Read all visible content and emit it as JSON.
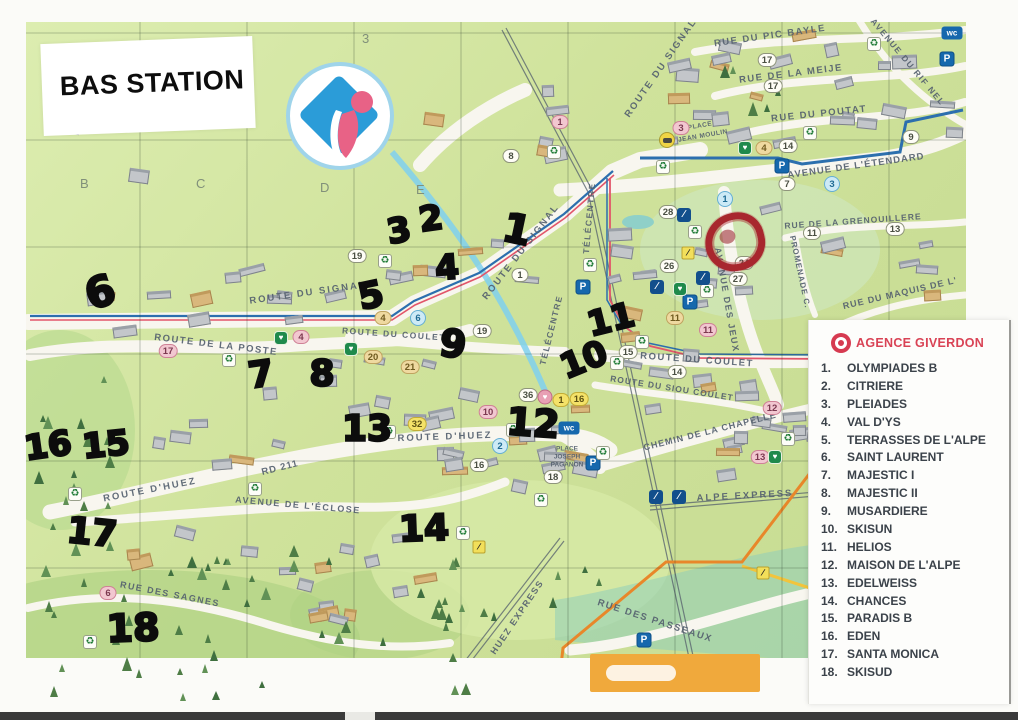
{
  "page": {
    "title": "BAS STATION"
  },
  "legend": {
    "agency": "AGENCE GIVERDON",
    "items": [
      {
        "num": "1.",
        "label": "OLYMPIADES B"
      },
      {
        "num": "2.",
        "label": "CITRIERE"
      },
      {
        "num": "3.",
        "label": "PLEIADES"
      },
      {
        "num": "4.",
        "label": "VAL D'YS"
      },
      {
        "num": "5.",
        "label": "TERRASSES DE L'ALPE"
      },
      {
        "num": "6.",
        "label": "SAINT LAURENT"
      },
      {
        "num": "7.",
        "label": "MAJESTIC I"
      },
      {
        "num": "8.",
        "label": "MAJESTIC II"
      },
      {
        "num": "9.",
        "label": "MUSARDIERE"
      },
      {
        "num": "10.",
        "label": "SKISUN"
      },
      {
        "num": "11.",
        "label": "HELIOS"
      },
      {
        "num": "12.",
        "label": "MAISON DE L'ALPE"
      },
      {
        "num": "13.",
        "label": "EDELWEISS"
      },
      {
        "num": "14.",
        "label": "CHANCES"
      },
      {
        "num": "15.",
        "label": "PARADIS B"
      },
      {
        "num": "16.",
        "label": "EDEN"
      },
      {
        "num": "17.",
        "label": "SANTA MONICA"
      },
      {
        "num": "18.",
        "label": "SKISUD"
      }
    ]
  },
  "map": {
    "grid_labels": [
      {
        "text": "3",
        "x": 362,
        "y": 31
      },
      {
        "text": "B",
        "x": 80,
        "y": 176
      },
      {
        "text": "C",
        "x": 196,
        "y": 176
      },
      {
        "text": "D",
        "x": 320,
        "y": 180
      },
      {
        "text": "E",
        "x": 416,
        "y": 182
      }
    ],
    "streets": [
      {
        "label": "ROUTE DU SIGNAL",
        "x": 308,
        "y": 293,
        "rot": -8,
        "size": 9.5,
        "ls": 2
      },
      {
        "label": "ROUTE DU SIGNAL",
        "x": 521,
        "y": 252,
        "rot": -52,
        "size": 9.5,
        "ls": 2
      },
      {
        "label": "ROUTE DU SIGNAL",
        "x": 661,
        "y": 68,
        "rot": -55,
        "size": 9.5,
        "ls": 2
      },
      {
        "label": "RUE DU PIC BAYLE",
        "x": 770,
        "y": 36,
        "rot": -8,
        "size": 9.5,
        "ls": 1.5
      },
      {
        "label": "RUE DE LA MEIJE",
        "x": 791,
        "y": 74,
        "rot": -7,
        "size": 9.5,
        "ls": 1.5
      },
      {
        "label": "RUE DU POUTAT",
        "x": 819,
        "y": 114,
        "rot": -6,
        "size": 9.5,
        "ls": 1.5
      },
      {
        "label": "AVENUE DU RIF NEL",
        "x": 908,
        "y": 62,
        "rot": 50,
        "size": 8.5,
        "ls": 1.5
      },
      {
        "label": "AVENUE DE L'ÉTENDARD",
        "x": 856,
        "y": 166,
        "rot": -8,
        "size": 9.5,
        "ls": 1
      },
      {
        "label": "RUE DE LA GRENOUILLERE",
        "x": 853,
        "y": 221,
        "rot": -4,
        "size": 8.5,
        "ls": 1
      },
      {
        "label": "RUE DU MAQUIS DE L'",
        "x": 900,
        "y": 293,
        "rot": -13,
        "size": 9,
        "ls": 1
      },
      {
        "label": "PROMENADE C.",
        "x": 800,
        "y": 272,
        "rot": 78,
        "size": 8,
        "ls": 1
      },
      {
        "label": "AVENUE DES JEUX",
        "x": 727,
        "y": 300,
        "rot": 80,
        "size": 9,
        "ls": 1.5
      },
      {
        "label": "TÉLÉCENTRE",
        "x": 589,
        "y": 218,
        "rot": -85,
        "size": 8.5,
        "ls": 1.5
      },
      {
        "label": "TÉLÉCENTRE",
        "x": 551,
        "y": 330,
        "rot": -76,
        "size": 8.5,
        "ls": 1.5
      },
      {
        "label": "PLACE",
        "x": 700,
        "y": 126,
        "rot": -10,
        "size": 6.5,
        "ls": 0.5
      },
      {
        "label": "JEAN MOULIN",
        "x": 703,
        "y": 136,
        "rot": -10,
        "size": 6.5,
        "ls": 0.5
      },
      {
        "label": "ROUTE DU COULET",
        "x": 394,
        "y": 334,
        "rot": 4,
        "size": 8.5,
        "ls": 1.5
      },
      {
        "label": "ROUTE DU COULET",
        "x": 697,
        "y": 360,
        "rot": 4,
        "size": 9.5,
        "ls": 1.5
      },
      {
        "label": "ROUTE DU SIOU COULET",
        "x": 672,
        "y": 388,
        "rot": 9,
        "size": 8.5,
        "ls": 1
      },
      {
        "label": "CHEMIN DE LA CHAPELLE",
        "x": 710,
        "y": 431,
        "rot": -14,
        "size": 9,
        "ls": 1
      },
      {
        "label": "ROUTE DE LA POSTE",
        "x": 216,
        "y": 345,
        "rot": 7,
        "size": 9.5,
        "ls": 1.5
      },
      {
        "label": "ROUTE D'HUEZ",
        "x": 445,
        "y": 437,
        "rot": -2,
        "size": 9.5,
        "ls": 2
      },
      {
        "label": "ROUTE D'HUEZ",
        "x": 150,
        "y": 490,
        "rot": -11,
        "size": 9.5,
        "ls": 2
      },
      {
        "label": "RD 211",
        "x": 280,
        "y": 468,
        "rot": -14,
        "size": 9.5,
        "ls": 1
      },
      {
        "label": "AVENUE DE L'ÉCLOSE",
        "x": 298,
        "y": 505,
        "rot": 5,
        "size": 9,
        "ls": 1.5
      },
      {
        "label": "RUE DES SAGNES",
        "x": 170,
        "y": 594,
        "rot": 11,
        "size": 9,
        "ls": 1.5
      },
      {
        "label": "HUEZ EXPRESS",
        "x": 517,
        "y": 617,
        "rot": -56,
        "size": 9,
        "ls": 1.5
      },
      {
        "label": "RUE DES PASSEAUX",
        "x": 655,
        "y": 621,
        "rot": 18,
        "size": 9.5,
        "ls": 1.5
      },
      {
        "label": "ALPE EXPRESS",
        "x": 745,
        "y": 496,
        "rot": -3,
        "size": 9.5,
        "ls": 2
      },
      {
        "label": "PLACE",
        "x": 567,
        "y": 449,
        "rot": 0,
        "size": 6.5,
        "ls": 0
      },
      {
        "label": "JOSEPH",
        "x": 567,
        "y": 457,
        "rot": 0,
        "size": 6.5,
        "ls": 0
      },
      {
        "label": "PAGANON",
        "x": 567,
        "y": 465,
        "rot": 0,
        "size": 6.5,
        "ls": 0
      }
    ],
    "handwritten": [
      {
        "text": "3",
        "x": 399,
        "y": 231,
        "size": 34,
        "rot": -10
      },
      {
        "text": "2",
        "x": 431,
        "y": 219,
        "size": 34,
        "rot": -8
      },
      {
        "text": "1",
        "x": 517,
        "y": 230,
        "size": 40,
        "rot": 12
      },
      {
        "text": "4",
        "x": 447,
        "y": 268,
        "size": 34,
        "rot": -4
      },
      {
        "text": "5",
        "x": 371,
        "y": 296,
        "size": 36,
        "rot": -12
      },
      {
        "text": "6",
        "x": 100,
        "y": 292,
        "size": 42,
        "rot": -18
      },
      {
        "text": "7",
        "x": 261,
        "y": 375,
        "size": 36,
        "rot": -8
      },
      {
        "text": "8",
        "x": 322,
        "y": 374,
        "size": 36,
        "rot": 0
      },
      {
        "text": "9",
        "x": 453,
        "y": 344,
        "size": 38,
        "rot": 8
      },
      {
        "text": "10",
        "x": 584,
        "y": 360,
        "size": 34,
        "rot": -22
      },
      {
        "text": "11",
        "x": 611,
        "y": 320,
        "size": 34,
        "rot": -14
      },
      {
        "text": "12",
        "x": 533,
        "y": 423,
        "size": 38,
        "rot": 4
      },
      {
        "text": "13",
        "x": 367,
        "y": 429,
        "size": 36,
        "rot": 0
      },
      {
        "text": "14",
        "x": 424,
        "y": 529,
        "size": 36,
        "rot": -2
      },
      {
        "text": "15",
        "x": 106,
        "y": 445,
        "size": 34,
        "rot": -6
      },
      {
        "text": "16",
        "x": 48,
        "y": 446,
        "size": 34,
        "rot": -8
      },
      {
        "text": "17",
        "x": 92,
        "y": 533,
        "size": 36,
        "rot": 6
      },
      {
        "text": "18",
        "x": 133,
        "y": 628,
        "size": 38,
        "rot": -2
      }
    ],
    "badges": [
      {
        "text": "8",
        "color": "white",
        "x": 511,
        "y": 156
      },
      {
        "text": "19",
        "color": "white",
        "x": 357,
        "y": 256
      },
      {
        "text": "1",
        "color": "pink",
        "x": 560,
        "y": 122
      },
      {
        "text": "17",
        "color": "white",
        "x": 767,
        "y": 60
      },
      {
        "text": "17",
        "color": "white",
        "x": 773,
        "y": 86
      },
      {
        "text": "3",
        "color": "pink",
        "x": 681,
        "y": 128
      },
      {
        "text": "4",
        "color": "tan",
        "x": 764,
        "y": 148
      },
      {
        "text": "14",
        "color": "white",
        "x": 788,
        "y": 146
      },
      {
        "text": "9",
        "color": "white",
        "x": 911,
        "y": 137
      },
      {
        "text": "7",
        "color": "white",
        "x": 787,
        "y": 184
      },
      {
        "text": "3",
        "color": "blue",
        "x": 832,
        "y": 184
      },
      {
        "text": "1",
        "color": "blue",
        "x": 725,
        "y": 199
      },
      {
        "text": "28",
        "color": "white",
        "x": 668,
        "y": 212
      },
      {
        "text": "11",
        "color": "white",
        "x": 812,
        "y": 233
      },
      {
        "text": "13",
        "color": "white",
        "x": 895,
        "y": 229
      },
      {
        "text": "26",
        "color": "white",
        "x": 669,
        "y": 266
      },
      {
        "text": "24",
        "color": "white",
        "x": 744,
        "y": 263
      },
      {
        "text": "27",
        "color": "white",
        "x": 738,
        "y": 279
      },
      {
        "text": "11",
        "color": "tan",
        "x": 675,
        "y": 318
      },
      {
        "text": "11",
        "color": "pink",
        "x": 708,
        "y": 330
      },
      {
        "text": "15",
        "color": "white",
        "x": 628,
        "y": 352
      },
      {
        "text": "14",
        "color": "white",
        "x": 677,
        "y": 372
      },
      {
        "text": "12",
        "color": "pink",
        "x": 772,
        "y": 408
      },
      {
        "text": "13",
        "color": "pink",
        "x": 760,
        "y": 457
      },
      {
        "text": "1",
        "color": "white",
        "x": 520,
        "y": 275
      },
      {
        "text": "19",
        "color": "white",
        "x": 482,
        "y": 331
      },
      {
        "text": "4",
        "color": "pink",
        "x": 301,
        "y": 337
      },
      {
        "text": "4",
        "color": "tan",
        "x": 383,
        "y": 318
      },
      {
        "text": "6",
        "color": "blue",
        "x": 418,
        "y": 318
      },
      {
        "text": "17",
        "color": "pink",
        "x": 168,
        "y": 351
      },
      {
        "text": "20",
        "color": "tan",
        "x": 373,
        "y": 357
      },
      {
        "text": "21",
        "color": "tan",
        "x": 410,
        "y": 367
      },
      {
        "text": "36",
        "color": "white",
        "x": 528,
        "y": 395
      },
      {
        "text": "1",
        "color": "yellow",
        "x": 561,
        "y": 400
      },
      {
        "text": "16",
        "color": "yellow",
        "x": 579,
        "y": 399
      },
      {
        "text": "10",
        "color": "pink",
        "x": 488,
        "y": 412
      },
      {
        "text": "32",
        "color": "yellow",
        "x": 417,
        "y": 424
      },
      {
        "text": "2",
        "color": "blue",
        "x": 500,
        "y": 446
      },
      {
        "text": "16",
        "color": "white",
        "x": 479,
        "y": 465
      },
      {
        "text": "18",
        "color": "white",
        "x": 553,
        "y": 477
      },
      {
        "text": "6",
        "color": "pink",
        "x": 108,
        "y": 593
      }
    ],
    "icons": [
      {
        "type": "parking",
        "x": 947,
        "y": 59
      },
      {
        "type": "parking",
        "x": 782,
        "y": 166
      },
      {
        "type": "parking",
        "x": 690,
        "y": 302
      },
      {
        "type": "parking",
        "x": 583,
        "y": 287
      },
      {
        "type": "parking",
        "x": 593,
        "y": 463
      },
      {
        "type": "parking",
        "x": 644,
        "y": 640
      },
      {
        "type": "wc",
        "x": 952,
        "y": 33
      },
      {
        "type": "wc",
        "x": 569,
        "y": 428
      },
      {
        "type": "recycle",
        "x": 874,
        "y": 44
      },
      {
        "type": "recycle",
        "x": 810,
        "y": 133
      },
      {
        "type": "recycle",
        "x": 663,
        "y": 167
      },
      {
        "type": "recycle",
        "x": 554,
        "y": 152
      },
      {
        "type": "recycle",
        "x": 695,
        "y": 232
      },
      {
        "type": "recycle",
        "x": 707,
        "y": 291
      },
      {
        "type": "recycle",
        "x": 590,
        "y": 265
      },
      {
        "type": "recycle",
        "x": 642,
        "y": 342
      },
      {
        "type": "recycle",
        "x": 617,
        "y": 363
      },
      {
        "type": "recycle",
        "x": 229,
        "y": 360
      },
      {
        "type": "recycle",
        "x": 389,
        "y": 432
      },
      {
        "type": "recycle",
        "x": 513,
        "y": 430
      },
      {
        "type": "recycle",
        "x": 541,
        "y": 500
      },
      {
        "type": "recycle",
        "x": 75,
        "y": 494
      },
      {
        "type": "recycle",
        "x": 255,
        "y": 489
      },
      {
        "type": "recycle",
        "x": 90,
        "y": 642
      },
      {
        "type": "recycle",
        "x": 463,
        "y": 533
      },
      {
        "type": "recycle",
        "x": 788,
        "y": 439
      },
      {
        "type": "recycle",
        "x": 603,
        "y": 453
      },
      {
        "type": "recycle",
        "x": 385,
        "y": 261
      },
      {
        "type": "heart",
        "x": 745,
        "y": 148
      },
      {
        "type": "heart",
        "x": 281,
        "y": 338
      },
      {
        "type": "heart",
        "x": 351,
        "y": 349
      },
      {
        "type": "heart",
        "x": 775,
        "y": 457
      },
      {
        "type": "heart",
        "x": 680,
        "y": 289
      },
      {
        "type": "mitten",
        "x": 545,
        "y": 397
      },
      {
        "type": "taxi",
        "x": 667,
        "y": 140
      },
      {
        "type": "blue",
        "x": 684,
        "y": 215
      },
      {
        "type": "blue",
        "x": 703,
        "y": 278
      },
      {
        "type": "blue",
        "x": 657,
        "y": 287
      },
      {
        "type": "blue",
        "x": 656,
        "y": 497
      },
      {
        "type": "blue",
        "x": 679,
        "y": 497
      },
      {
        "type": "skier",
        "x": 479,
        "y": 547
      },
      {
        "type": "skier",
        "x": 763,
        "y": 573
      },
      {
        "type": "skier",
        "x": 688,
        "y": 253
      }
    ]
  },
  "colors": {
    "accent_red": "#d94355",
    "marker_black": "#0c0c0c",
    "map_green": "#cfe29b",
    "boundary_blue": "#2c6fae",
    "boundary_red": "#e2556a",
    "slope_blue": "#7fd0ee",
    "lift_orange": "#e8872a"
  }
}
